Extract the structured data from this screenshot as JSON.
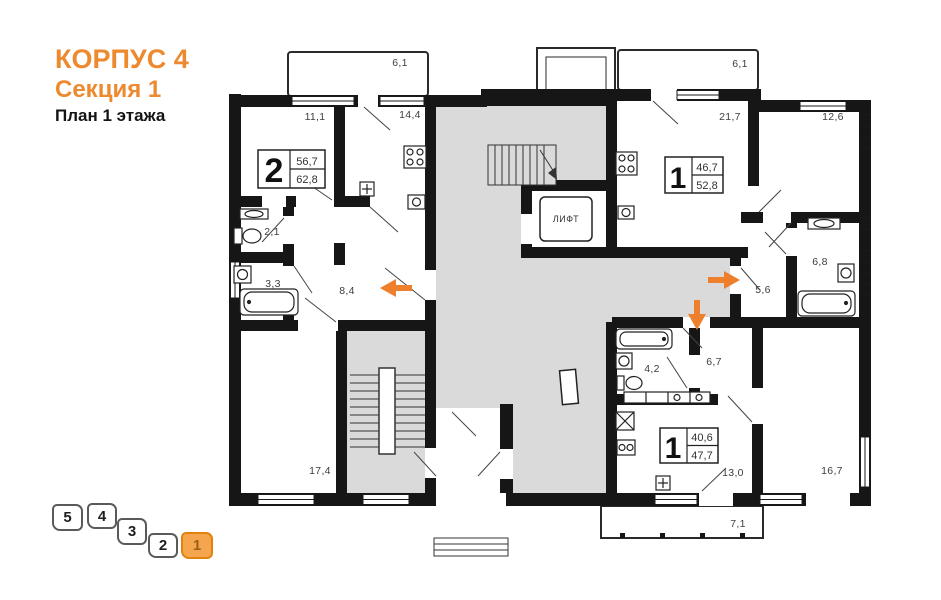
{
  "header": {
    "building": "КОРПУС 4",
    "section": "Секция 1",
    "floor_plan": "План 1 этажа"
  },
  "colors": {
    "accent": "#ED8A2F",
    "wall": "#161616",
    "common_area": "#DADADA",
    "selected_fill": "#F4A54E",
    "selected_border": "#E2820C"
  },
  "apartments": [
    {
      "rooms": "2",
      "area_living": "56,7",
      "area_total": "62,8"
    },
    {
      "rooms": "1",
      "area_living": "46,7",
      "area_total": "52,8"
    },
    {
      "rooms": "1",
      "area_living": "40,6",
      "area_total": "47,7"
    }
  ],
  "room_labels": {
    "balcony_left": "6,1",
    "room_left": "11,1",
    "kitchen_left": "14,4",
    "balcony_right": "6,1",
    "living_right": "21,7",
    "room_right": "12,6",
    "wc_left": "2,1",
    "bath_left": "3,3",
    "hall_left": "8,4",
    "bath_right": "6,8",
    "hall_right": "5,6",
    "bath_bottom": "4,2",
    "hall_bottom": "6,7",
    "room_bottom_left": "17,4",
    "kitchen_bottom": "13,0",
    "room_bottom_right": "16,7",
    "balcony_bottom": "7,1"
  },
  "elevator_label": "ЛИФТ",
  "section_selector": {
    "items": [
      {
        "label": "5",
        "selected": false
      },
      {
        "label": "4",
        "selected": false
      },
      {
        "label": "3",
        "selected": false
      },
      {
        "label": "2",
        "selected": false
      },
      {
        "label": "1",
        "selected": true
      }
    ]
  }
}
